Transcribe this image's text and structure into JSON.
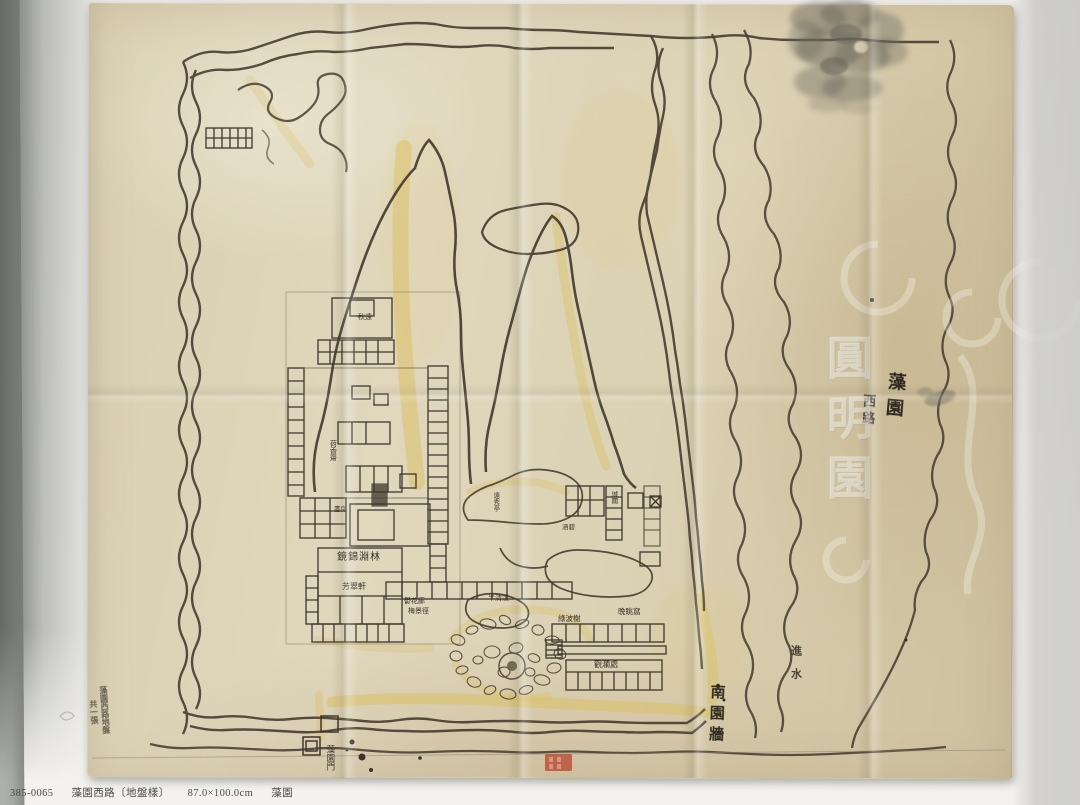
{
  "caption": {
    "catalog_no": "385-0065",
    "title": "藻園西路〔地盤樣〕",
    "dimensions": "87.0×100.0cm",
    "collection": "藻園"
  },
  "map": {
    "watermark_text": "圓明園",
    "labels": {
      "hall_north": "秋遠",
      "studio_west": "荷香齋",
      "room_note": "書房",
      "main_hall": "鏡錦淵林",
      "hall_fangcui": "芳翠軒",
      "gallery_yuhua": "鬱花廊",
      "path_meijing": "梅景徑",
      "hall_banqingyang": "半清漾",
      "pavilion_yuanxiu": "遠秀亭",
      "pavilion_hanbi": "涵碧",
      "gate_tower": "城關",
      "pavilion_lvbo": "綠波榭",
      "studio_wantiao": "晚眺窩",
      "hall_guanlan": "觀瀾處",
      "gate_south": "藻園門"
    },
    "annotations": {
      "wall_note": "南園牆",
      "water_inlet": "進水",
      "hw_right_col1": "藻園",
      "hw_right_col2": "西路",
      "hw_left_col1": "藻園西路地盤",
      "hw_left_col2": "共一張"
    },
    "colors": {
      "paper": "#dcd1b4",
      "ink": "#42392d",
      "highlight": "#d9c05e",
      "seal": "#b5452f"
    }
  }
}
